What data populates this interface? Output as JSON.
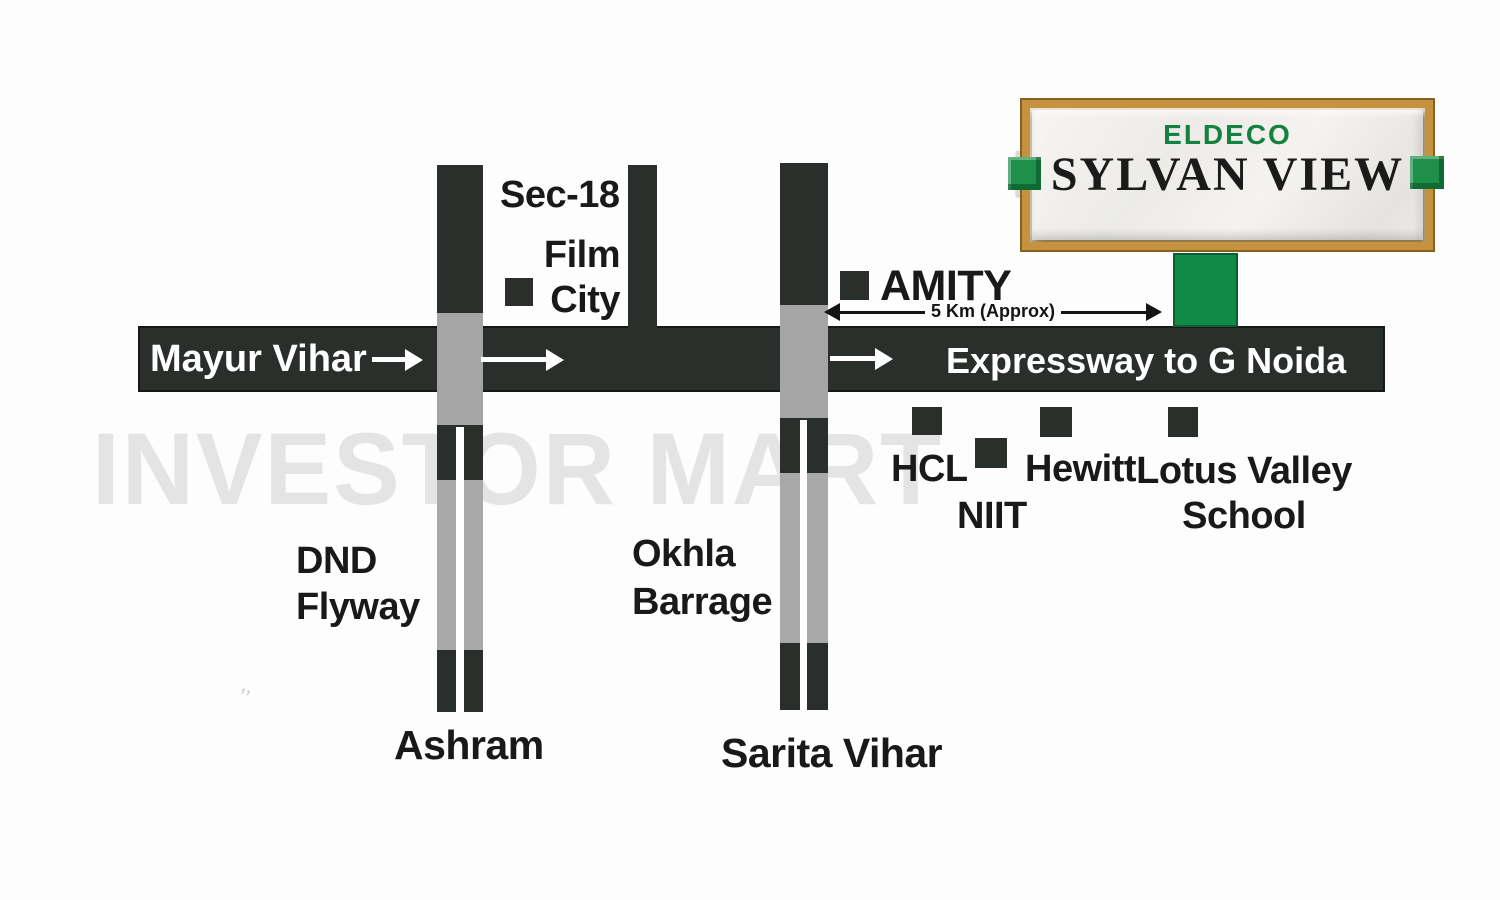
{
  "watermark": "INVESTOR MART",
  "logo": {
    "brand": "ELDECO",
    "project": "SYLVAN VIEW"
  },
  "roads": {
    "mayur_vihar": "Mayur Vihar",
    "expressway": "Expressway to G Noida",
    "dnd_line1": "DND",
    "dnd_line2": "Flyway",
    "ashram": "Ashram",
    "okhla_line1": "Okhla",
    "okhla_line2": "Barrage",
    "sarita_vihar": "Sarita Vihar"
  },
  "landmarks": {
    "sec18": "Sec-18",
    "film_line1": "Film",
    "film_line2": "City",
    "amity": "AMITY",
    "hcl": "HCL",
    "niit": "NIIT",
    "hewitt": "Hewitt",
    "lotus_line1": "Lotus Valley",
    "lotus_line2": "School"
  },
  "distance": {
    "label": "5 Km (Approx)"
  },
  "colors": {
    "road_dark": "#2b2f2b",
    "intersection_gray": "#a5a5a5",
    "site_green": "#0f8a47",
    "frame_gold": "#c5923f",
    "brand_green": "#14813f",
    "watermark_gray": "#e4e4e4"
  }
}
